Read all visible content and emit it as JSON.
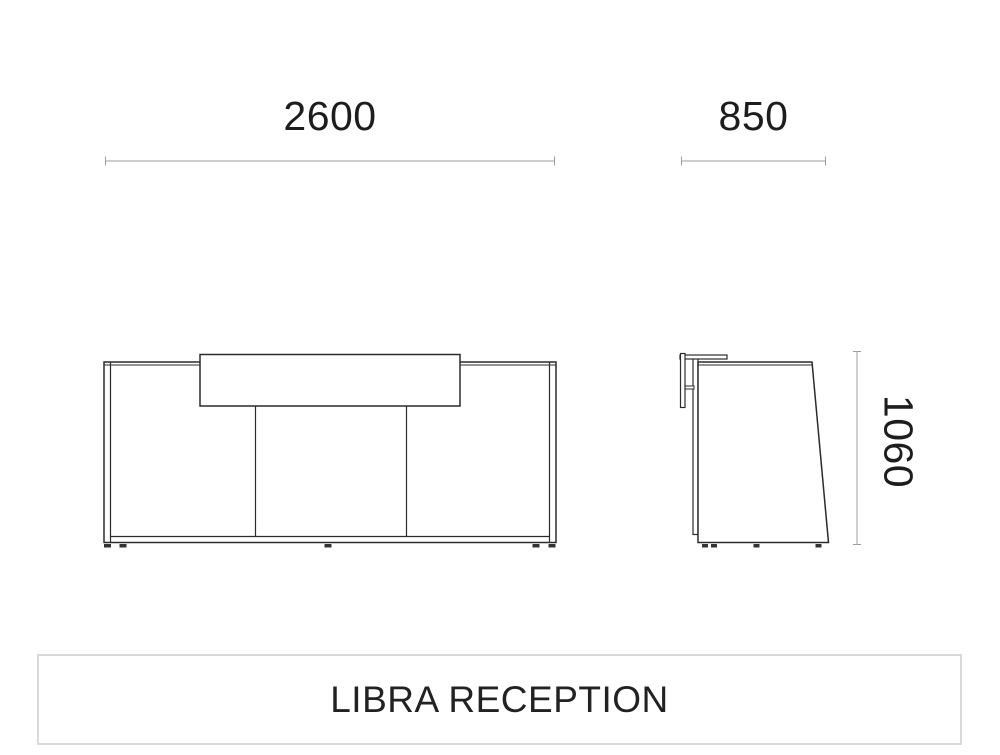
{
  "title": {
    "text": "LIBRA RECEPTION"
  },
  "drawing": {
    "product_name": "LIBRA RECEPTION",
    "dimensions": {
      "width": {
        "value": "2600",
        "applies_to": "front-view-overall-width"
      },
      "depth": {
        "value": "850",
        "applies_to": "side-view-overall-depth"
      },
      "height": {
        "value": "1060",
        "applies_to": "overall-height"
      }
    },
    "views": {
      "front": "front-elevation-of-reception-desk",
      "side": "side-elevation-of-reception-desk"
    }
  },
  "colors": {
    "background": "#ffffff",
    "drawing_stroke": "#2b2b2b",
    "dimension_line": "#9e9e9e",
    "label_text": "#1d1d1d",
    "title_border": "#d9d9d9",
    "feet_fill": "#333333"
  }
}
